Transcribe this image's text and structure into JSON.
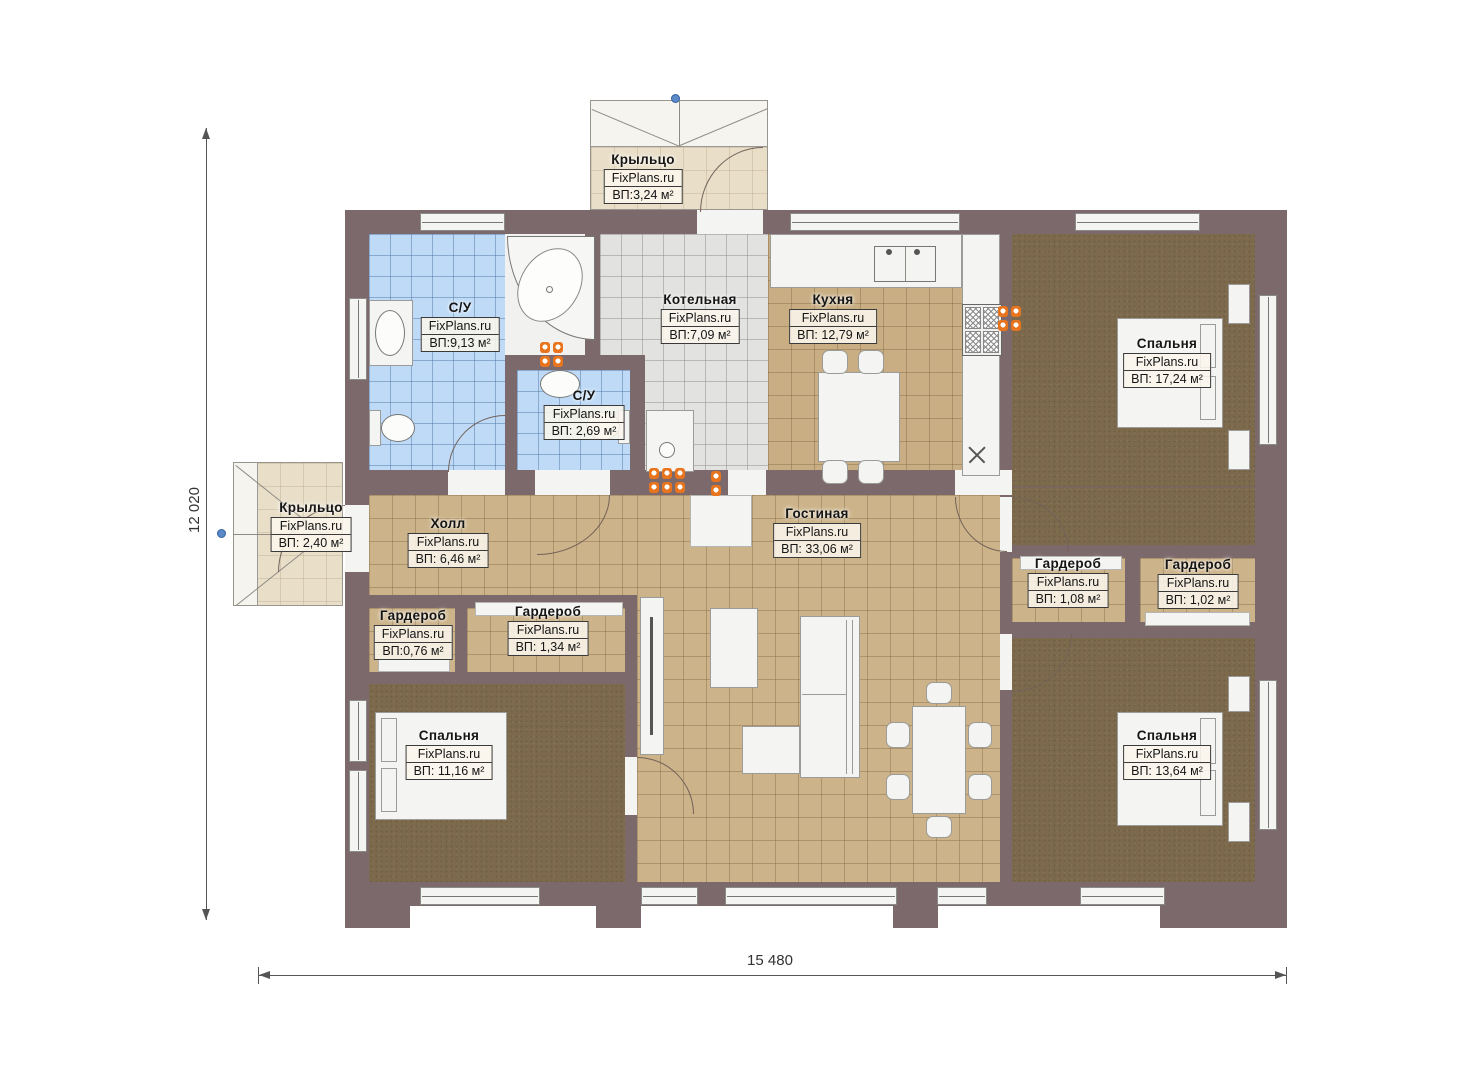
{
  "watermark": "FixPlans.ru",
  "dimensions": {
    "height": "12 020",
    "width": "15 480"
  },
  "rooms": [
    {
      "name": "С/У",
      "area": "ВП:9,13 м²"
    },
    {
      "name": "С/У",
      "area": "ВП: 2,69 м²"
    },
    {
      "name": "Котельная",
      "area": "ВП:7,09 м²"
    },
    {
      "name": "Кухня",
      "area": "ВП: 12,79 м²"
    },
    {
      "name": "Спальня",
      "area": "ВП: 17,24 м²"
    },
    {
      "name": "Крыльцо",
      "area": "ВП:3,24 м²"
    },
    {
      "name": "Крыльцо",
      "area": "ВП: 2,40 м²"
    },
    {
      "name": "Холл",
      "area": "ВП: 6,46 м²"
    },
    {
      "name": "Гостиная",
      "area": "ВП: 33,06 м²"
    },
    {
      "name": "Гардероб",
      "area": "ВП: 1,08 м²"
    },
    {
      "name": "Гардероб",
      "area": "ВП: 1,02 м²"
    },
    {
      "name": "Гардероб",
      "area": "ВП:0,76 м²"
    },
    {
      "name": "Гардероб",
      "area": "ВП: 1,34 м²"
    },
    {
      "name": "Спальня",
      "area": "ВП: 11,16 м²"
    },
    {
      "name": "Спальня",
      "area": "ВП: 13,64 м²"
    }
  ],
  "colors": {
    "wall": "#7c696b",
    "floor_tile": "#ccb389",
    "carpet": "#7d6a4c",
    "bath_tile": "#bedaf6",
    "boiler_tile": "#e2e2e0",
    "porch_floor": "#e9dfc9",
    "radiator": "#e8741e",
    "marker": "#5b8ac9"
  }
}
